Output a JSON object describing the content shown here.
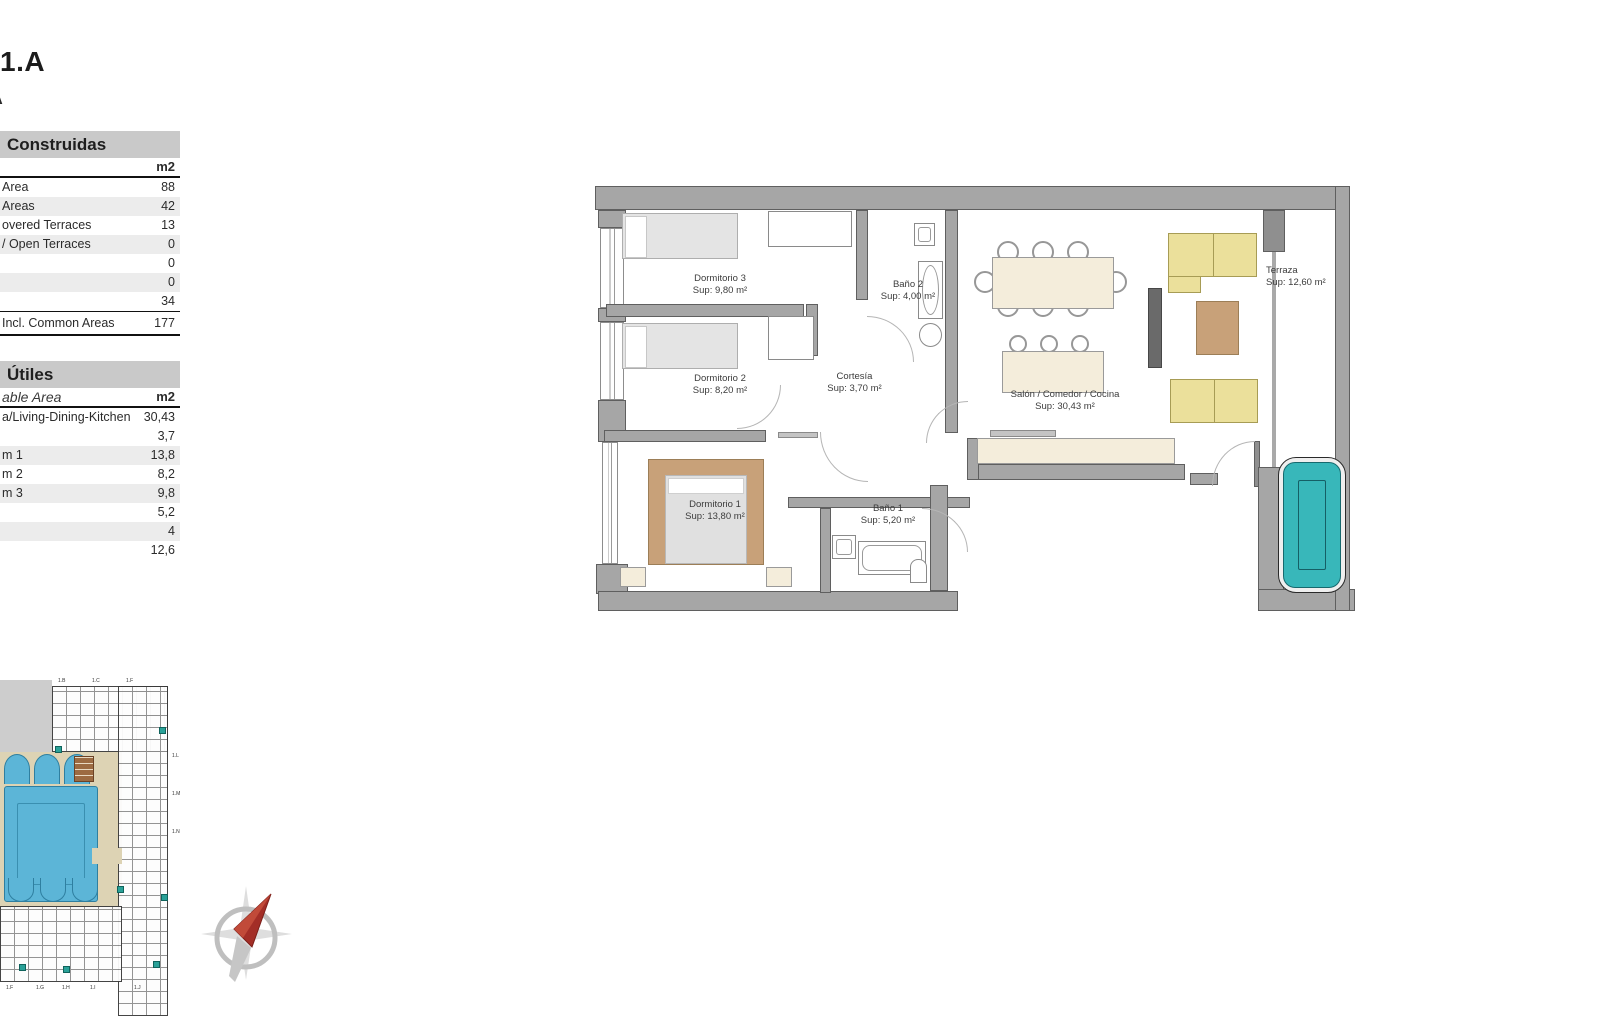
{
  "document": {
    "title": "1.A",
    "title_fragment": "A"
  },
  "tables": {
    "built": {
      "header": "Construidas",
      "unit": "m2",
      "rows": [
        {
          "label": "Area",
          "value": "88"
        },
        {
          "label": "Areas",
          "value": "42"
        },
        {
          "label": "overed Terraces",
          "value": "13"
        },
        {
          "label": "/ Open Terraces",
          "value": "0"
        },
        {
          "label": "",
          "value": "0"
        },
        {
          "label": "",
          "value": "0"
        },
        {
          "label": "",
          "value": "34"
        }
      ],
      "total_label": "Incl. Common Areas",
      "total_value": "177"
    },
    "usable": {
      "header": "Útiles",
      "subheader": "able Area",
      "unit": "m2",
      "rows": [
        {
          "label": "a/Living-Dining-Kitchen",
          "value": "30,43"
        },
        {
          "label": "",
          "value": "3,7"
        },
        {
          "label": "m 1",
          "value": "13,8"
        },
        {
          "label": "m 2",
          "value": "8,2"
        },
        {
          "label": "m 3",
          "value": "9,8"
        },
        {
          "label": "",
          "value": "5,2"
        },
        {
          "label": "",
          "value": "4"
        },
        {
          "label": "",
          "value": "12,6"
        }
      ]
    }
  },
  "floorplan": {
    "rooms": [
      {
        "name": "Dormitorio 3",
        "sup": "Sup: 9,80 m²"
      },
      {
        "name": "Baño 2",
        "sup": "Sup: 4,00 m²"
      },
      {
        "name": "Dormitorio 2",
        "sup": "Sup: 8,20 m²"
      },
      {
        "name": "Cortesía",
        "sup": "Sup: 3,70 m²"
      },
      {
        "name": "Salón / Comedor / Cocina",
        "sup": "Sup: 30,43 m²"
      },
      {
        "name": "Terraza",
        "sup": "Sup: 12,60 m²"
      },
      {
        "name": "Dormitorio 1",
        "sup": "Sup: 13,80 m²"
      },
      {
        "name": "Baño 1",
        "sup": "Sup: 5,20 m²"
      }
    ]
  },
  "siteplan": {
    "labels_top": [
      "1.B",
      "1.C",
      "1.F"
    ],
    "labels_bottom": [
      "1.F",
      "1.G",
      "1.H",
      "1.I",
      "1.J"
    ],
    "labels_right": [
      "1.L",
      "1.M",
      "1.N"
    ]
  },
  "colors": {
    "wall_gray": "#a6a6a6",
    "plan_pool_teal": "#38b7ba",
    "site_pool_blue": "#5cb5d7",
    "deck_beige": "#ddd3b4",
    "sofa_yellow": "#ebe09b",
    "wood_brown": "#c8a179",
    "furniture_cream": "#f4eddb",
    "unit_highlight_teal": "#2aa198",
    "compass_red": "#a32e27"
  }
}
